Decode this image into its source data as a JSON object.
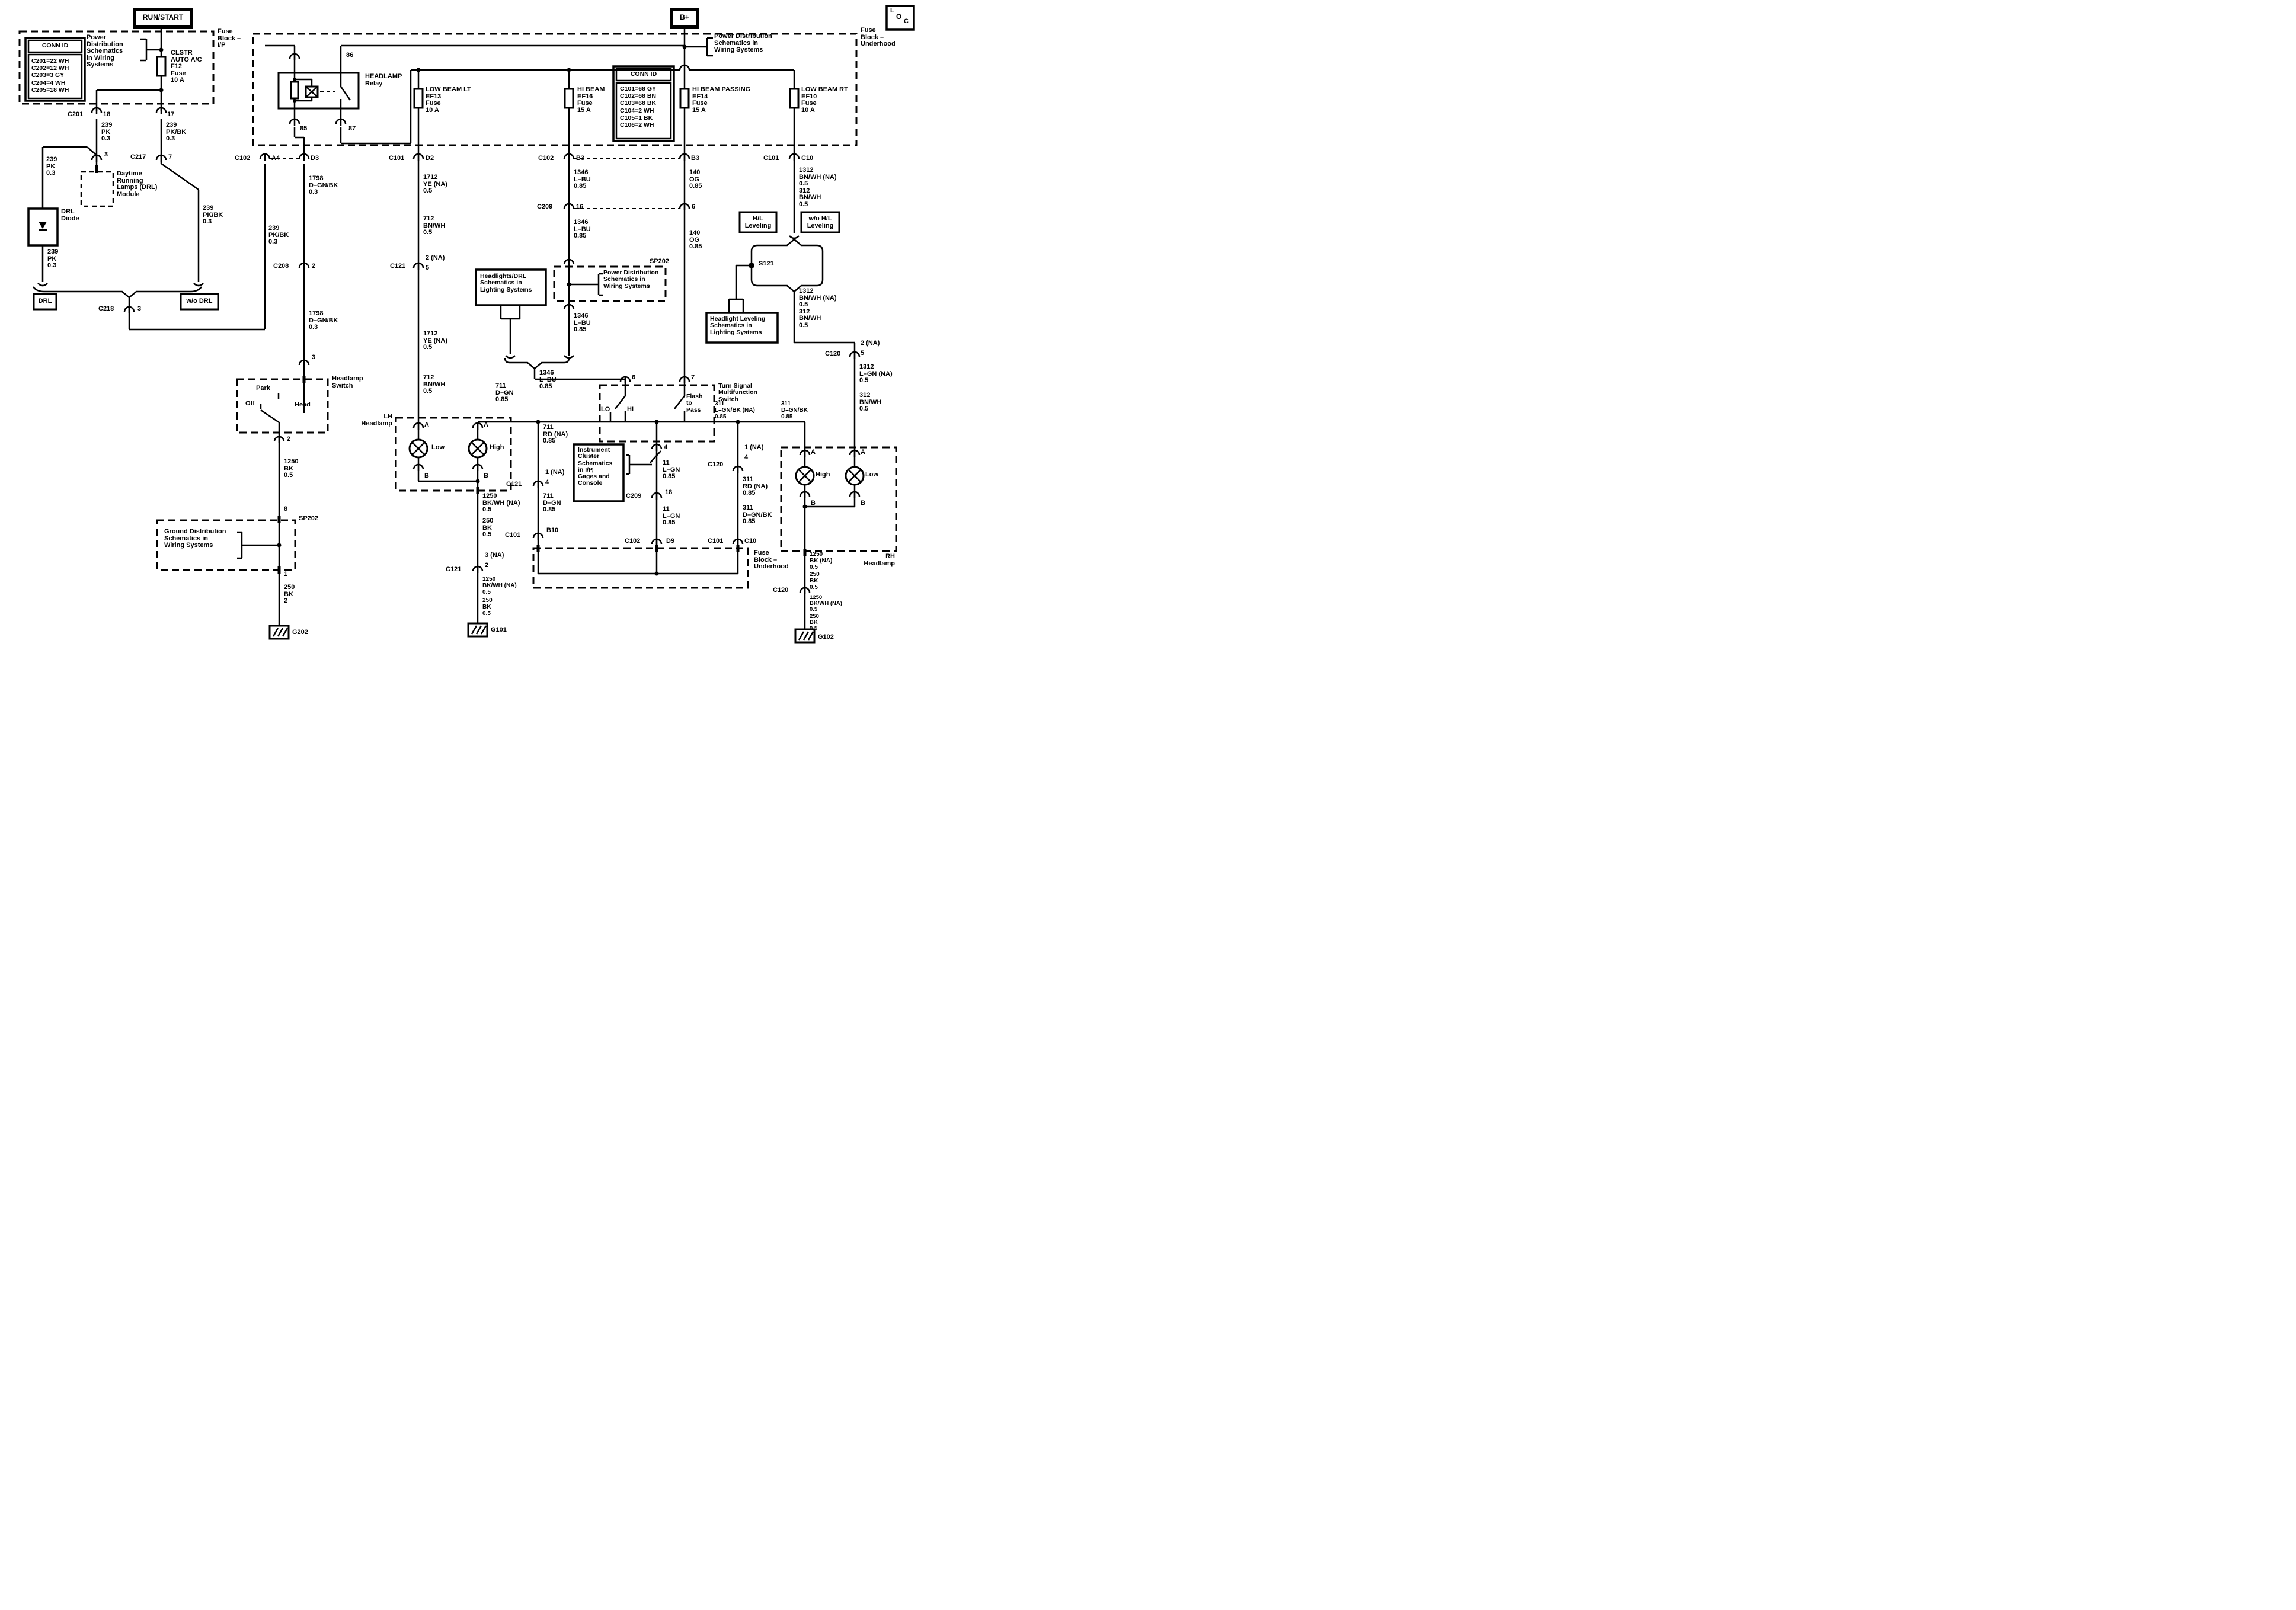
{
  "colors": {
    "ink": "#000000",
    "paper": "#ffffff"
  },
  "labels": {
    "rs": "RUN/START",
    "bplus": "B+",
    "locL": "L",
    "locO": "O",
    "locC": "C",
    "fbip": "Fuse\nBlock –\nI/P",
    "fbuh_top": "Fuse\nBlock –\nUnderhood",
    "fbuh_bot": "Fuse\nBlock –\nUnderhood",
    "connid1_t": "CONN ID",
    "connid1_r": "C201=22 WH\nC202=12 WH\nC203=3 GY\nC204=4 WH\nC205=18 WH",
    "connid2_t": "CONN ID",
    "connid2_r": "C101=68 GY\nC102=68 BN\nC103=68 BK\nC104=2 WH\nC105=1 BK\nC106=2 WH",
    "pd1": "Power\nDistribution\nSchematics\nin Wiring\nSystems",
    "pd2": "Power Distribution\nSchematics in\nWiring Systems",
    "pd3": "Power Distribution\nSchematics in\nWiring Systems",
    "gnddist": "Ground Distribution\nSchematics in\nWiring Systems",
    "hldrl": "Headlights/DRL\nSchematics in\nLighting Systems",
    "hll": "Headlight Leveling\nSchematics in\nLighting Systems",
    "ic": "Instrument\nCluster\nSchematics\nin I/P,\nGages and\nConsole",
    "clstr": "CLSTR\nAUTO A/C\nF12\nFuse\n10 A",
    "ef13": "LOW BEAM LT\nEF13\nFuse\n10 A",
    "ef16": "HI BEAM\nEF16\nFuse\n15 A",
    "ef14": "HI BEAM PASSING\nEF14\nFuse\n15 A",
    "ef10": "LOW BEAM RT\nEF10\nFuse\n10 A",
    "relay": "HEADLAMP\nRelay",
    "n86": "86",
    "n85": "85",
    "n87": "87",
    "c201": "C201",
    "n18": "18",
    "n17": "17",
    "w239a": "239\nPK\n0.3",
    "w239b": "239\nPK/BK\n0.3",
    "n3": "3",
    "c217": "C217",
    "n7": "7",
    "module": "Daytime\nRunning\nLamps (DRL)\nModule",
    "w239c": "239\nPK\n0.3",
    "drl_diode": "DRL\nDiode",
    "w239d": "239\nPK\n0.3",
    "w239e": "239\nPK/BK\n0.3",
    "drl": "DRL",
    "wodrl": "w/o DRL",
    "c218": "C218",
    "n3b": "3",
    "c102a": "C102",
    "a4": "A4",
    "d3": "D3",
    "c101a": "C101",
    "d2": "D2",
    "c102b": "C102",
    "b3a": "B3",
    "b3b": "B3",
    "c101b": "C101",
    "c10a": "C10",
    "w239f": "239\nPK/BK\n0.3",
    "w1798a": "1798\nD–GN/BK\n0.3",
    "c208": "C208",
    "n2": "2",
    "w1798b": "1798\nD–GN/BK\n0.3",
    "n3c": "3",
    "hs": "Headlamp\nSwitch",
    "park": "Park",
    "off": "Off",
    "head": "Head",
    "n2b": "2",
    "w1250a": "1250\nBK\n0.5",
    "n8": "8",
    "sp202a": "SP202",
    "n1": "1",
    "w250a": "250\nBK\n2",
    "g202": "G202",
    "w1712a": "1712\nYE (NA)\n0.5",
    "w712a": "712\nBN/WH\n0.5",
    "n2na": "2 (NA)",
    "n5": "5",
    "c121a": "C121",
    "w1712b": "1712\nYE (NA)\n0.5",
    "w712b": "712\nBN/WH\n0.5",
    "w1346a": "1346\nL–BU\n0.85",
    "c209a": "C209",
    "n16": "16",
    "w1346b": "1346\nL–BU\n0.85",
    "sp202b": "SP202",
    "w1346c": "1346\nL–BU\n0.85",
    "w1346d": "1346\nL–BU\n0.85",
    "w711a": "711\nD–GN\n0.85",
    "w140a": "140\nOG\n0.85",
    "n6a": "6",
    "w140b": "140\nOG\n0.85",
    "n6b": "6",
    "n7b": "7",
    "ts": "Turn Signal\nMultifunction\nSwitch",
    "lo": "LO",
    "hi": "HI",
    "flash": "Flash\nto\nPass",
    "n4a": "4",
    "w311a": "311\nL–GN/BK (NA)\n0.85",
    "w311b": "311\nD–GN/BK\n0.85",
    "w11a": "11\nL–GN\n0.85",
    "c120a": "C120",
    "n18b": "18",
    "c209b": "C209",
    "w11b": "11\nL–GN\n0.85",
    "c102c": "C102",
    "d9": "D9",
    "c101c": "C101",
    "c10b": "C10",
    "n1na": "1 (NA)",
    "n4b": "4",
    "w311rd": "311\nRD (NA)\n0.85",
    "w311c": "311\nD–GN/BK\n0.85",
    "w711rd": "711\nRD (NA)\n0.85",
    "c121b": "C121",
    "n1na2": "1 (NA)",
    "n4c": "4",
    "w711b": "711\nD–GN\n0.85",
    "c101d": "C101",
    "b10": "B10",
    "lh": "LH\nHeadlamp",
    "rh": "RH\nHeadlamp",
    "A": "A",
    "B": "B",
    "low": "Low",
    "high": "High",
    "w1250b": "1250\nBK/WH (NA)\n0.5",
    "w250b": "250\nBK\n0.5",
    "n3na": "3 (NA)",
    "n2c": "2",
    "c121c": "C121",
    "w1250c": "1250\nBK/WH (NA)\n0.5",
    "w250c": "250\nBK\n0.5",
    "g101": "G101",
    "w1312a": "1312\nBN/WH (NA)\n0.5\n312\nBN/WH\n0.5",
    "hl": "H/L\nLeveling",
    "wohl": "w/o H/L\nLeveling",
    "s121": "S121",
    "w1312b": "1312\nBN/WH (NA)\n0.5\n312\nBN/WH\n0.5",
    "n2na2": "2 (NA)",
    "n5b": "5",
    "c120b": "C120",
    "w1312c": "1312\nL–GN (NA)\n0.5",
    "w312a": "312\nBN/WH\n0.5",
    "w1250d": "1250\nBK (NA)\n0.5",
    "w250d": "250\nBK\n0.5",
    "c120c": "C120",
    "w1250e": "1250\nBK/WH (NA)\n0.5",
    "w250e": "250\nBK\n0.5",
    "g102": "G102"
  }
}
